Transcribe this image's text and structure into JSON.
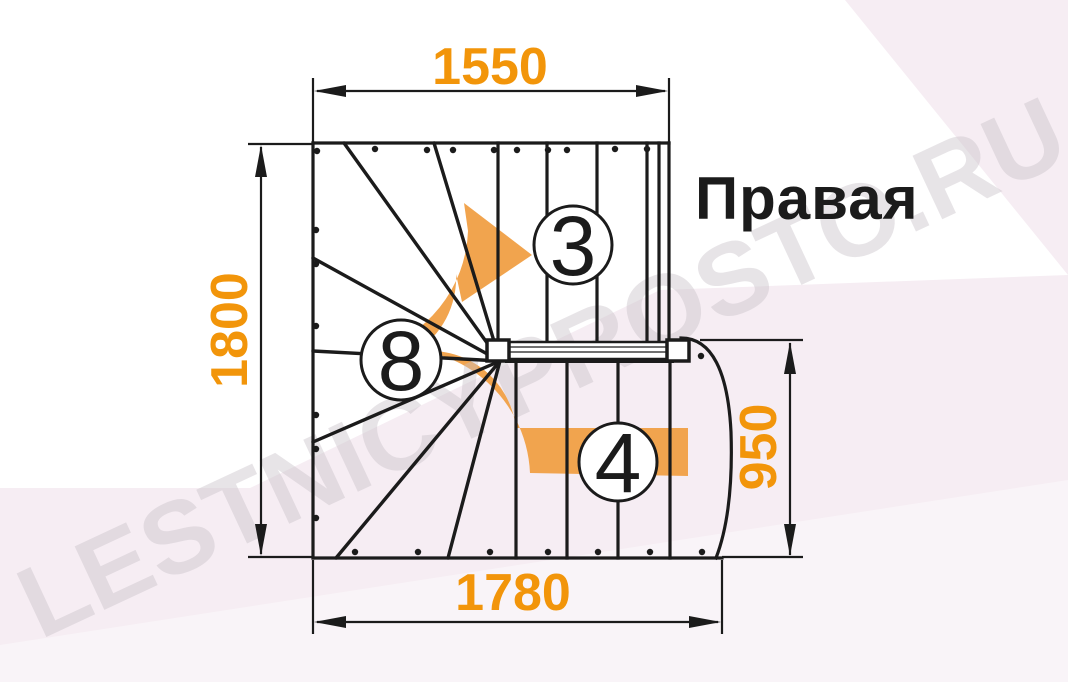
{
  "diagram": {
    "label": "Правая",
    "watermark": "LESTNICYPROSTO.RU",
    "dimensions_mm": {
      "top": "1550",
      "left": "1800",
      "right": "950",
      "bottom": "1780"
    },
    "step_counts": {
      "upper_flight": "3",
      "winders": "8",
      "lower_flight": "4"
    },
    "colors": {
      "dimension_text": "#F2950A",
      "arrow": "#F1A44E",
      "line": "#1B1B1B",
      "background_pink": "#F6EDF3",
      "background_white": "#FFFFFF",
      "label_text": "#1B1B1B",
      "watermark": "#C8C1C8"
    }
  }
}
